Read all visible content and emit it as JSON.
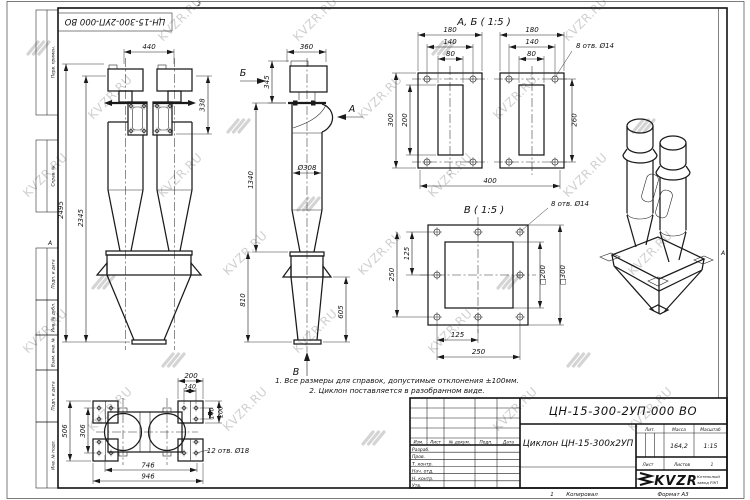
{
  "watermark": {
    "text": "KVZR.RU"
  },
  "frame": {
    "fold_top": "2",
    "fold_left": "А",
    "fold_right": "А",
    "copy_index": "1",
    "copied": "Копировал",
    "format": "Формат А3",
    "corner_designation": "ЦН-15-300-2УП-000 ВО"
  },
  "margin": {
    "b1": "Перв. примен.",
    "b2": "Справ. №",
    "b3": "Подп. и дата",
    "b4": "Инв. № дубл.",
    "b5": "Взам. инв. №",
    "b6": "Подп. и дата",
    "b7": "Инв. № подл."
  },
  "notes": {
    "line1": "1. Все размеры для справок, допустимые отклонения ±100мм.",
    "line2": "2. Циклон поставляется в разобранном виде."
  },
  "stamp": {
    "designation": "ЦН-15-300-2УП-000 ВО",
    "name": "Циклон ЦН-15-300х2УП",
    "lit_label": "Лит.",
    "mass_label": "Масса",
    "scale_label": "Масштаб",
    "mass": "164,2",
    "scale": "1:15",
    "sheet_label": "Лист",
    "sheets_label": "Листов",
    "sheets_value": "1",
    "col_izm": "Изм.",
    "col_list": "Лист",
    "col_doc": "№ докум.",
    "col_sign": "Подп.",
    "col_date": "Дата",
    "row1": "Разраб.",
    "row2": "Пров.",
    "row3": "Т. контр.",
    "row4": "Нач. отд.",
    "row5": "Н. контр.",
    "row6": "Утв.",
    "logo_text": "KVZR",
    "logo_sub1": "Котельный",
    "logo_sub2": "завод РЭП"
  },
  "front_view": {
    "d_width": "440",
    "d_flange": "338",
    "d_h1": "2495",
    "d_h2": "2345"
  },
  "side_view": {
    "d_width": "360",
    "d_top": "345",
    "d_mid": "1340",
    "d_dia": "Ø308",
    "d_cone": "810",
    "d_out": "605",
    "arrow_a": "А",
    "arrow_b": "Б",
    "arrow_v": "В"
  },
  "flange_view": {
    "title": "А, Б ( 1:5 )",
    "holes": "8 отв. Ø14",
    "l_w": "180",
    "l_bolt": "140",
    "l_open": "80",
    "l_h": "300",
    "l_open_h": "200",
    "r_w": "180",
    "r_bolt": "140",
    "r_open": "80",
    "r_h": "260",
    "total": "400"
  },
  "view_b": {
    "title": "В ( 1:5 )",
    "holes": "8 отв. Ø14",
    "left_full": "250",
    "left_half": "125",
    "bot_half": "125",
    "bot_full": "250",
    "sq_in": "□200",
    "sq_out": "□300"
  },
  "bottom_view": {
    "holes": "12 отв. Ø18",
    "top_w": "200",
    "top_bolt": "140",
    "r_bolt": "140",
    "r_w": "200",
    "l_h": "506",
    "l_bolt": "306",
    "b_bolt": "746",
    "b_w": "946"
  }
}
